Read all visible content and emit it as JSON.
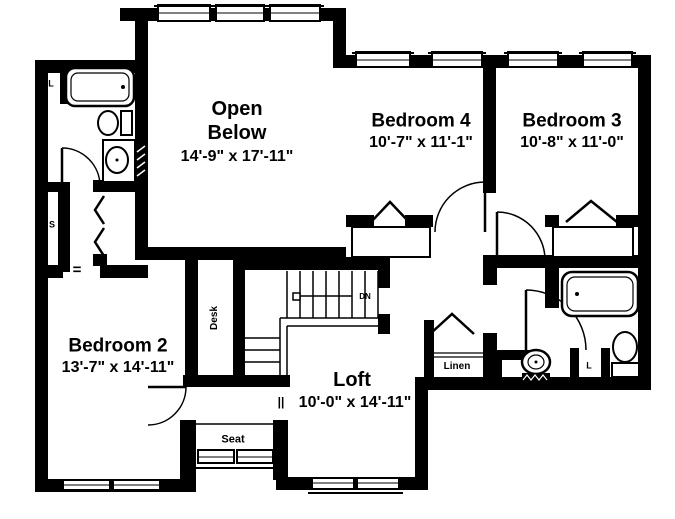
{
  "rooms": {
    "open_below": {
      "name_line1": "Open",
      "name_line2": "Below",
      "dimensions": "14'-9\" x 17'-11\""
    },
    "bedroom4": {
      "name": "Bedroom 4",
      "dimensions": "10'-7\" x 11'-1\""
    },
    "bedroom3": {
      "name": "Bedroom 3",
      "dimensions": "10'-8\" x 11'-0\""
    },
    "bedroom2": {
      "name": "Bedroom 2",
      "dimensions": "13'-7\" x 14'-11\""
    },
    "loft": {
      "name": "Loft",
      "dimensions": "10'-0\" x 14'-11\""
    }
  },
  "labels": {
    "linen": "Linen",
    "seat": "Seat",
    "desk": "Desk",
    "down": "DN",
    "linen_closet_abbr": "L",
    "shelves_abbr": "S",
    "opening_symbol": "=",
    "railing_symbol": "||"
  },
  "colors": {
    "wall": "#000000",
    "background": "#ffffff",
    "text": "#000000"
  }
}
